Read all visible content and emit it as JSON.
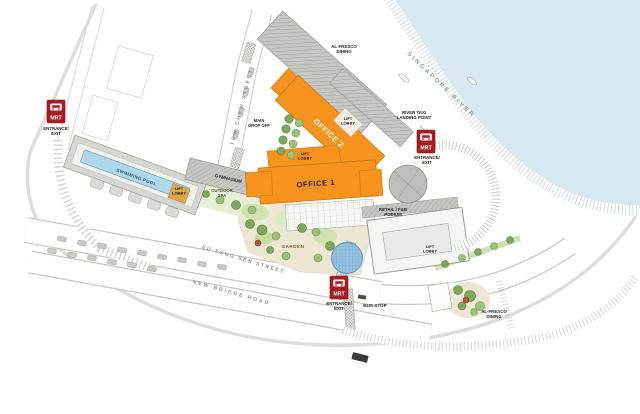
{
  "palette": {
    "office_orange": "#F6921E",
    "mrt_red": "#A51E22",
    "water_blue": "#D9E8F0",
    "pool_blue": "#AED7EA",
    "garden_green": "#CFE3B2",
    "roof_gray": "#C6C6C2"
  },
  "labels": {
    "singapore_river": "SINGAPORE RIVER",
    "al_fresco_dining": "AL-FRESCO\nDINING",
    "river_taxi_landing_point": "RIVER TAXI\nLANDING POINT",
    "mrt": "MRT",
    "mrt_entrance_exit": "ENTRANCE/\nEXIT",
    "office_1": "OFFICE 1",
    "office_2": "OFFICE 2",
    "main_drop_off": "MAIN\nDROP OFF",
    "lift_lobby": "LIFT\nLOBBY",
    "swimming_pool": "SWIMMING POOL",
    "gymnasium": "GYMNASIUM",
    "outdoor_spa": "OUTDOOR\nSPA",
    "retail_fnb_podium": "RETAIL / F&B\nPODIUM",
    "garden": "GARDEN",
    "bus_stop": "BUS STOP",
    "streets": {
      "tew_chew_street": "TEW CHEW STREET",
      "eu_tong_sen_street": "EU TONG SEN STREET",
      "new_bridge_road": "NEW BRIDGE ROAD"
    }
  }
}
